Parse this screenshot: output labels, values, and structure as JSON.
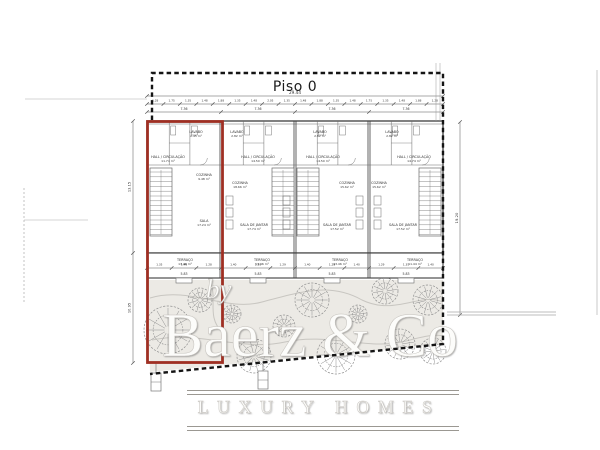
{
  "title": {
    "text": "Piso 0"
  },
  "watermark": {
    "by": "by",
    "brand": "Baerz & Co",
    "tagline": "LUXURY HOMES"
  },
  "colors": {
    "red_outline": "#9f2f23",
    "wall": "#3d3d3d",
    "thin": "#6b6b6b",
    "dim": "#555555",
    "label": "#333333",
    "boundary": "#141414",
    "garden_fill": "#eceae5",
    "path": "#c8c6c1",
    "tree": "#8f8f8f",
    "faint": "#aaaaaa"
  },
  "plan": {
    "building": {
      "x": 147,
      "y": 121,
      "w": 296,
      "wall_bottom": 253,
      "terrace_bottom": 278,
      "party_walls": [
        221,
        295,
        369
      ]
    },
    "units": [
      {
        "name": "unit-1-highlighted",
        "x0": 147,
        "x1": 221,
        "rooms": [
          {
            "label": "HALL / CIRCULAÇÃO",
            "area": "11.74 m²",
            "x": 168,
            "y": 158
          },
          {
            "label": "LAVABO",
            "area": "2.45 m²",
            "x": 196,
            "y": 133
          },
          {
            "label": "COZINHA",
            "area": "9.48 m²",
            "x": 204,
            "y": 176
          },
          {
            "label": "SALA",
            "area": "17.24 m²",
            "x": 204,
            "y": 222
          },
          {
            "label": "TERRAÇO",
            "area": "13.46 m²",
            "x": 185,
            "y": 261
          }
        ]
      },
      {
        "name": "unit-2",
        "x0": 221,
        "x1": 295,
        "rooms": [
          {
            "label": "LAVABO",
            "area": "2.82 m²",
            "x": 237,
            "y": 133
          },
          {
            "label": "HALL / CIRCULAÇÃO",
            "area": "14.50 m²",
            "x": 258,
            "y": 158
          },
          {
            "label": "COZINHA",
            "area": "18.66 m²",
            "x": 240,
            "y": 184
          },
          {
            "label": "SALA DE JANTAR",
            "area": "17.74 m²",
            "x": 254,
            "y": 226
          },
          {
            "label": "TERRAÇO",
            "area": "13.46 m²",
            "x": 262,
            "y": 261
          }
        ]
      },
      {
        "name": "unit-3",
        "x0": 295,
        "x1": 369,
        "rooms": [
          {
            "label": "LAVABO",
            "area": "2.82 m²",
            "x": 320,
            "y": 133
          },
          {
            "label": "HALL / CIRCULAÇÃO",
            "area": "14.50 m²",
            "x": 323,
            "y": 158
          },
          {
            "label": "COZINHA",
            "area": "15.62 m²",
            "x": 347,
            "y": 184
          },
          {
            "label": "SALA DE JANTAR",
            "area": "17.52 m²",
            "x": 337,
            "y": 226
          },
          {
            "label": "TERRAÇO",
            "area": "13.46 m²",
            "x": 340,
            "y": 261
          }
        ]
      },
      {
        "name": "unit-4",
        "x0": 369,
        "x1": 443,
        "rooms": [
          {
            "label": "LAVABO",
            "area": "2.82 m²",
            "x": 392,
            "y": 133
          },
          {
            "label": "HALL / CIRCULAÇÃO",
            "area": "14.74 m²",
            "x": 414,
            "y": 158
          },
          {
            "label": "COZINHA",
            "area": "15.62 m²",
            "x": 379,
            "y": 184
          },
          {
            "label": "SALA DE JANTAR",
            "area": "17.52 m²",
            "x": 403,
            "y": 226
          },
          {
            "label": "TERRAÇO",
            "area": "11.44 m²",
            "x": 415,
            "y": 261
          }
        ]
      }
    ],
    "stairs": [
      {
        "x": 150,
        "y": 168,
        "w": 22,
        "h": 68
      },
      {
        "x": 272,
        "y": 168,
        "w": 22,
        "h": 68
      },
      {
        "x": 297,
        "y": 168,
        "w": 22,
        "h": 68
      },
      {
        "x": 419,
        "y": 168,
        "w": 22,
        "h": 68
      }
    ],
    "kitchen_fixtures": [
      {
        "x": 226,
        "y": 196
      },
      {
        "x": 283,
        "y": 196
      },
      {
        "x": 356,
        "y": 196
      },
      {
        "x": 374,
        "y": 196
      }
    ],
    "dimensions": {
      "top_total": "29.44",
      "unit_widths": [
        "7.36",
        "7.36",
        "7.36",
        "7.36"
      ],
      "top_segments": [
        "1.28",
        "1.75",
        "1.35",
        "1.48",
        "1.88",
        "1.35",
        "1.48",
        "2.05",
        "1.35",
        "1.48",
        "1.88",
        "1.35",
        "1.48",
        "1.75",
        "1.35",
        "1.48",
        "1.88",
        "1.28"
      ],
      "bottom_segments": [
        "1.35",
        "1.40",
        "1.28",
        "1.40",
        "1.35",
        "1.29",
        "1.40",
        "1.28",
        "1.40",
        "1.29",
        "1.35",
        "1.40"
      ],
      "terrace_widths": [
        "5.83",
        "5.83",
        "5.83",
        "5.83"
      ],
      "left_upper": "13.15",
      "left_lower": "10.95",
      "right_total": "19.20"
    },
    "boundary": {
      "points": "152,120 152,73 443,73 443,344 150,374"
    },
    "highlight": {
      "x": 147.5,
      "y": 121.5,
      "w": 75,
      "h": 241
    },
    "garden": {
      "outline": "147,280 443,280 443,344 150,372",
      "paths": [
        "M150,298 C190,286 225,312 262,302 C300,292 330,282 362,300 C395,316 420,292 443,302",
        "M152,340 C200,330 240,352 285,342 C330,332 370,352 410,340 C425,336 436,334 443,336",
        "M210,282 C218,298 206,316 222,332"
      ],
      "trees": [
        {
          "x": 168,
          "y": 330,
          "r": 24
        },
        {
          "x": 200,
          "y": 300,
          "r": 12
        },
        {
          "x": 232,
          "y": 314,
          "r": 9
        },
        {
          "x": 254,
          "y": 356,
          "r": 17
        },
        {
          "x": 284,
          "y": 326,
          "r": 11
        },
        {
          "x": 312,
          "y": 300,
          "r": 17
        },
        {
          "x": 336,
          "y": 355,
          "r": 19
        },
        {
          "x": 358,
          "y": 314,
          "r": 9
        },
        {
          "x": 385,
          "y": 291,
          "r": 13
        },
        {
          "x": 400,
          "y": 344,
          "r": 15
        },
        {
          "x": 428,
          "y": 300,
          "r": 15
        },
        {
          "x": 433,
          "y": 351,
          "r": 13
        }
      ]
    },
    "entrance_symbols": [
      {
        "x": 151,
        "y": 373
      },
      {
        "x": 258,
        "y": 371
      }
    ],
    "misc_lines": [
      {
        "x1": 25,
        "y1": 99,
        "x2": 147,
        "y2": 99,
        "w": 0.6
      },
      {
        "x1": 24,
        "y1": 220,
        "x2": 88,
        "y2": 220,
        "w": 0.6
      },
      {
        "x1": 24,
        "y1": 188,
        "x2": 24,
        "y2": 302,
        "w": 0.7,
        "dash": "2 2"
      },
      {
        "x1": 597,
        "y1": 70,
        "x2": 597,
        "y2": 315,
        "w": 0.8,
        "c": "#bbbbbb"
      },
      {
        "x1": 447,
        "y1": 312,
        "x2": 556,
        "y2": 312,
        "w": 0.8,
        "c": "#a8a8a8"
      },
      {
        "x1": 447,
        "y1": 315,
        "x2": 556,
        "y2": 315,
        "w": 0.8,
        "c": "#a8a8a8"
      },
      {
        "x1": 436,
        "y1": 63,
        "x2": 436,
        "y2": 121,
        "w": 0.5,
        "c": "#999999"
      },
      {
        "x1": 440,
        "y1": 63,
        "x2": 440,
        "y2": 121,
        "w": 0.5,
        "c": "#999999"
      }
    ]
  }
}
